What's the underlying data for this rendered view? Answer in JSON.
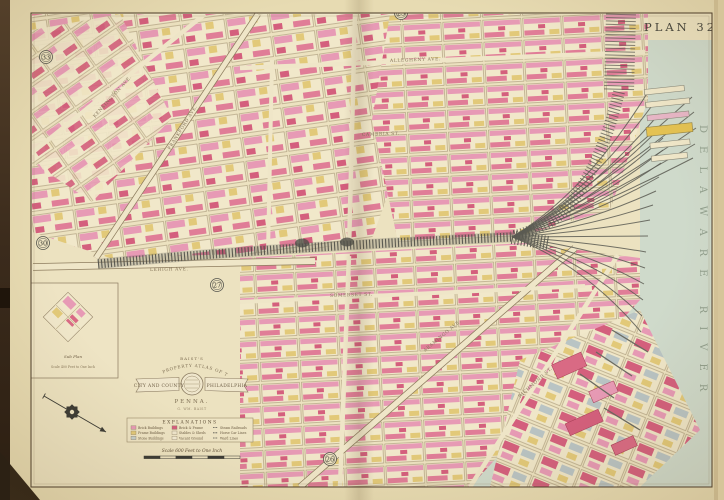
{
  "plate": {
    "title": "PLAN 32",
    "adjacent_plans": [
      "23",
      "33",
      "30",
      "27",
      "26"
    ]
  },
  "river_label": "DELAWARE RIVER",
  "cartouche": {
    "top": "BAIST'S",
    "arc": "PROPERTY ATLAS OF THE",
    "ribbon_left": "CITY AND COUNTY",
    "ribbon_right": "PHILADELPHIA",
    "state": "PENNA.",
    "credit": "G. WM. BAIST"
  },
  "inset": {
    "caption": "Sub Plan",
    "scale_note": "Scale 400 Feet to One Inch"
  },
  "legend": {
    "title": "EXPLANATIONS",
    "entries": [
      {
        "label": "Brick Buildings",
        "type": "swatch",
        "color": "#e79ab5"
      },
      {
        "label": "Frame Buildings",
        "type": "swatch",
        "color": "#e2c979"
      },
      {
        "label": "Stone Buildings",
        "type": "swatch",
        "color": "#c3cdc9"
      },
      {
        "label": "Brick & Frame",
        "type": "swatch",
        "color": "#d45f7d"
      },
      {
        "label": "Stables & Sheds",
        "type": "swatch",
        "color": "#efe6cc"
      },
      {
        "label": "Vacant Ground",
        "type": "swatch",
        "color": "#f2ead2"
      },
      {
        "label": "Steam Railroads",
        "type": "line"
      },
      {
        "label": "Horse Car Lines",
        "type": "line"
      },
      {
        "label": "Ward Lines",
        "type": "line"
      }
    ]
  },
  "scale_bar": {
    "text": "Scale 600 Feet to One Inch"
  },
  "streets": [
    {
      "label": "LEHIGH AVE.",
      "x": 150,
      "y": 271,
      "rot": -1
    },
    {
      "label": "FRANKFORD AVE.",
      "x": 170,
      "y": 150,
      "rot": -58
    },
    {
      "label": "KENSINGTON AVE.",
      "x": 95,
      "y": 118,
      "rot": -48
    },
    {
      "label": "ALLEGHENY AVE.",
      "x": 390,
      "y": 62,
      "rot": -2
    },
    {
      "label": "CAMBRIA ST.",
      "x": 362,
      "y": 136,
      "rot": -2
    },
    {
      "label": "SOMERSET ST.",
      "x": 330,
      "y": 297,
      "rot": -2
    },
    {
      "label": "ARAMINGO AVE.",
      "x": 425,
      "y": 352,
      "rot": -40
    },
    {
      "label": "RICHMOND ST.",
      "x": 520,
      "y": 398,
      "rot": -42
    }
  ],
  "colors": {
    "paper": "#e7dbb2",
    "map_interior": "#ece2c0",
    "river": "#cfdacb",
    "brick_pink": "#e79ab5",
    "brick_red": "#d45f7d",
    "frame_yellow": "#e2c979",
    "rail_gray": "#4f4f48",
    "pier_yellow": "#e4c252"
  }
}
